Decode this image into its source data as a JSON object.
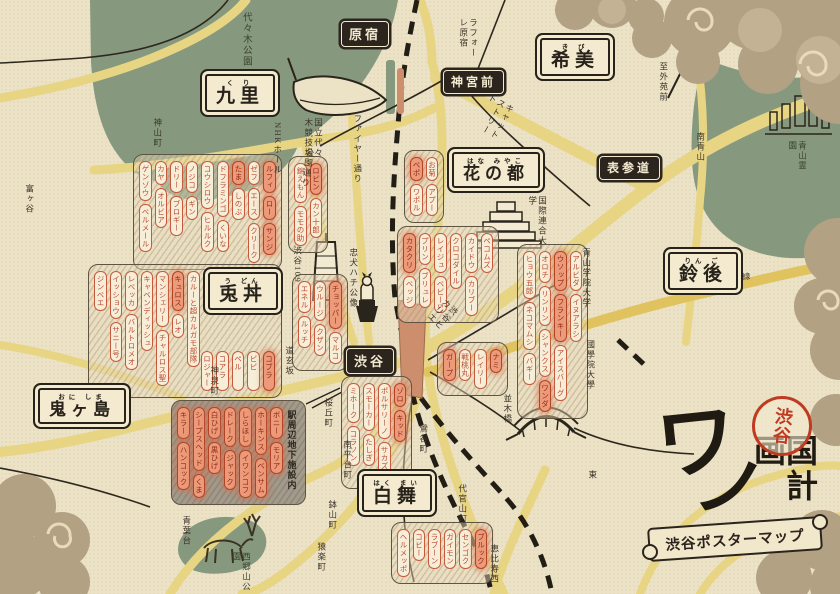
{
  "header": {
    "logo_char1": "ワ",
    "logo_char2": "ノ",
    "logo_chars_rest": "国計画",
    "seal": "渋谷",
    "banner": "渋谷ポスターマップ"
  },
  "stations": [
    {
      "name": "原宿"
    },
    {
      "name": "神宮前"
    },
    {
      "name": "表参道"
    },
    {
      "name": "渋谷"
    }
  ],
  "regions": [
    {
      "name": "九里",
      "furigana": "く り"
    },
    {
      "name": "希美",
      "furigana": "き び"
    },
    {
      "name": "花の都",
      "furigana": "はな みやこ"
    },
    {
      "name": "兎丼",
      "furigana": "う どん"
    },
    {
      "name": "鈴後",
      "furigana": "りん ご"
    },
    {
      "name": "鬼ヶ島",
      "furigana": "おに しま"
    },
    {
      "name": "白舞",
      "furigana": "はく まい"
    }
  ],
  "places": {
    "yoyogi_park": "代々木公園",
    "kamiyama": "神山町",
    "tomigaya": "富ヶ谷",
    "nhk_hall": "NHKホール",
    "gym": "国立代々木競技場",
    "laforet": "ラフォーレ原宿",
    "cat_street": "キャットストリート",
    "koen_dori": "公園通り",
    "fire_dori": "ファイヤー通り",
    "hachiko": "忠犬ハチ公像",
    "s109": "渋谷109",
    "hikarie": "渋谷ヒカリエ",
    "dogenzaka": "道玄坂",
    "shinsen": "神泉町",
    "uguisudani": "鶯谷町",
    "sakuragaoka": "桜丘町",
    "nanpeidai": "南平台町",
    "hachiyama": "鉢山町",
    "sarugaku": "猿楽町",
    "daikanyama": "代官山町",
    "ebisu_nishi": "恵比寿西",
    "higashi": "東",
    "aobadai": "青葉台",
    "saigoyama": "西郷山公園",
    "minami_aoyama": "南青山",
    "aoyama_cemetery": "青山霊園",
    "to_gaienmae": "至外苑前",
    "aogaku": "青山学院大学",
    "kokugakuin": "國學院大學",
    "un_univ": "国際連合大学",
    "shutoko": "首都高3号渋谷線",
    "namikibashi": "並木橋",
    "underground": "駅周辺地下施設内"
  },
  "clusters": {
    "a": {
      "columns": [
        [
          {
            "t": "ゲンゾウ",
            "hl": false
          },
          {
            "t": "ベルメール",
            "hl": false
          }
        ],
        [
          {
            "t": "カヤ",
            "hl": false
          },
          {
            "t": "オルビア",
            "hl": false
          }
        ],
        [
          {
            "t": "ドリー",
            "hl": false
          },
          {
            "t": "ブロギー",
            "hl": false
          }
        ],
        [
          {
            "t": "ノジコ",
            "hl": false
          },
          {
            "t": "ギン",
            "hl": false
          }
        ],
        [
          {
            "t": "コウシロウ",
            "hl": false
          },
          {
            "t": "ヒルルク",
            "hl": false
          }
        ],
        [
          {
            "t": "ドフラミンゴ",
            "hl": false
          },
          {
            "t": "くいな",
            "hl": false
          }
        ],
        [
          {
            "t": "たま",
            "hl": true
          },
          {
            "t": "しのぶ",
            "hl": false
          }
        ],
        [
          {
            "t": "ゼフ",
            "hl": false
          },
          {
            "t": "エース",
            "hl": false
          },
          {
            "t": "クリーク",
            "hl": false
          }
        ],
        [
          {
            "t": "ルフィ",
            "hl": true
          },
          {
            "t": "ロー",
            "hl": true
          },
          {
            "t": "サンジ",
            "hl": true
          }
        ]
      ]
    },
    "b": {
      "columns": [
        [
          {
            "t": "ジンベエ",
            "hl": false
          }
        ],
        [
          {
            "t": "イッショウ",
            "hl": false
          },
          {
            "t": "サニー号",
            "hl": false
          }
        ],
        [
          {
            "t": "レベッカ",
            "hl": false
          },
          {
            "t": "バルトロメオ",
            "hl": false
          }
        ],
        [
          {
            "t": "キャベンディッシュ",
            "hl": false
          }
        ],
        [
          {
            "t": "マンシェリー",
            "hl": false
          },
          {
            "t": "チャルロス聖",
            "hl": false
          }
        ],
        [
          {
            "t": "キュロス",
            "hl": true
          },
          {
            "t": "レオ",
            "hl": false
          }
        ],
        [
          {
            "t": "カルーと超カルガモ部隊",
            "hl": false
          }
        ]
      ],
      "row": [
        {
          "t": "ロジャー",
          "hl": false
        },
        {
          "t": "コアラ",
          "hl": false
        },
        {
          "t": "ペル",
          "hl": false
        },
        {
          "t": "ビビ",
          "hl": false
        },
        {
          "t": "コブラ",
          "hl": true
        }
      ]
    },
    "c": {
      "columns": [
        [
          {
            "t": "エネル",
            "hl": false
          },
          {
            "t": "ルッチ",
            "hl": false
          }
        ],
        [
          {
            "t": "ウルージ",
            "hl": false
          },
          {
            "t": "クザン",
            "hl": false
          }
        ],
        [
          {
            "t": "チョッパー",
            "hl": true
          },
          {
            "t": "マルコ",
            "hl": false
          }
        ]
      ]
    },
    "d": {
      "columns": [
        [
          {
            "t": "錦えもん",
            "hl": false
          },
          {
            "t": "モモの助",
            "hl": false
          }
        ],
        [
          {
            "t": "ロビン",
            "hl": true
          },
          {
            "t": "カン十郎",
            "hl": false
          }
        ]
      ]
    },
    "e": {
      "columns": [
        [
          {
            "t": "ベポ",
            "hl": true
          },
          {
            "t": "ワポル",
            "hl": false
          }
        ],
        [
          {
            "t": "お菊",
            "hl": false
          },
          {
            "t": "アプー",
            "hl": false
          }
        ]
      ]
    },
    "f": {
      "columns": [
        [
          {
            "t": "カタクリ",
            "hl": true
          },
          {
            "t": "ベッジ",
            "hl": false
          }
        ],
        [
          {
            "t": "プリン",
            "hl": false
          },
          {
            "t": "ブリュレ",
            "hl": false
          }
        ],
        [
          {
            "t": "レイジュ",
            "hl": false
          },
          {
            "t": "ベビー5",
            "hl": false
          }
        ],
        [
          {
            "t": "クロコダイル",
            "hl": false
          }
        ],
        [
          {
            "t": "カイドウ",
            "hl": false
          },
          {
            "t": "カリブー",
            "hl": false
          }
        ],
        [
          {
            "t": "ペコムズ",
            "hl": false
          }
        ]
      ]
    },
    "g": {
      "columns": [
        [
          {
            "t": "ヒョウ五郎",
            "hl": false
          },
          {
            "t": "ネコマムシ",
            "hl": false
          },
          {
            "t": "バギー",
            "hl": false
          }
        ],
        [
          {
            "t": "オロチ",
            "hl": false
          },
          {
            "t": "リンリン",
            "hl": false
          },
          {
            "t": "シャンクス",
            "hl": false
          },
          {
            "t": "ワンダ",
            "hl": true
          }
        ],
        [
          {
            "t": "ウソップ",
            "hl": true
          },
          {
            "t": "フランキー",
            "hl": true
          },
          {
            "t": "アイスバーグ",
            "hl": false
          }
        ],
        [
          {
            "t": "アルビダ",
            "hl": false
          },
          {
            "t": "イヌアラシ",
            "hl": false
          }
        ]
      ]
    },
    "h": {
      "columns": [
        [
          {
            "t": "ガープ",
            "hl": true
          }
        ],
        [
          {
            "t": "戦桃丸",
            "hl": false
          }
        ],
        [
          {
            "t": "レイリー",
            "hl": false
          }
        ],
        [
          {
            "t": "ナミ",
            "hl": true
          }
        ]
      ]
    },
    "i": {
      "columns": [
        [
          {
            "t": "ミホーク",
            "hl": false
          },
          {
            "t": "コラソン",
            "hl": false
          }
        ],
        [
          {
            "t": "スモーカー",
            "hl": false
          },
          {
            "t": "たしぎ",
            "hl": false
          }
        ],
        [
          {
            "t": "ポルサリーノ",
            "hl": false
          },
          {
            "t": "サカズキ",
            "hl": false
          }
        ],
        [
          {
            "t": "ゾロ",
            "hl": true
          },
          {
            "t": "キッド",
            "hl": true
          }
        ]
      ]
    },
    "j": {
      "columns": [
        [
          {
            "t": "ヘルメッポ",
            "hl": false
          }
        ],
        [
          {
            "t": "コビー",
            "hl": false
          }
        ],
        [
          {
            "t": "ラブーン",
            "hl": false
          }
        ],
        [
          {
            "t": "ガイモン",
            "hl": false
          }
        ],
        [
          {
            "t": "センゴク",
            "hl": false
          }
        ],
        [
          {
            "t": "ブルック",
            "hl": true
          }
        ]
      ]
    },
    "k": {
      "columns": [
        [
          {
            "t": "キラー",
            "hl": true
          },
          {
            "t": "ハンコック",
            "hl": true
          }
        ],
        [
          {
            "t": "シープスヘッド",
            "hl": true
          },
          {
            "t": "くま",
            "hl": true
          }
        ],
        [
          {
            "t": "白ひげ",
            "hl": true
          },
          {
            "t": "黒ひげ",
            "hl": true
          }
        ],
        [
          {
            "t": "ドレーク",
            "hl": true
          },
          {
            "t": "ジャック",
            "hl": true
          }
        ],
        [
          {
            "t": "しらほし",
            "hl": true
          },
          {
            "t": "イワンコフ",
            "hl": true
          }
        ],
        [
          {
            "t": "ホーキンス",
            "hl": true
          },
          {
            "t": "ベンサム",
            "hl": true
          }
        ],
        [
          {
            "t": "ボニー",
            "hl": true
          },
          {
            "t": "モリア",
            "hl": true
          }
        ]
      ]
    }
  }
}
